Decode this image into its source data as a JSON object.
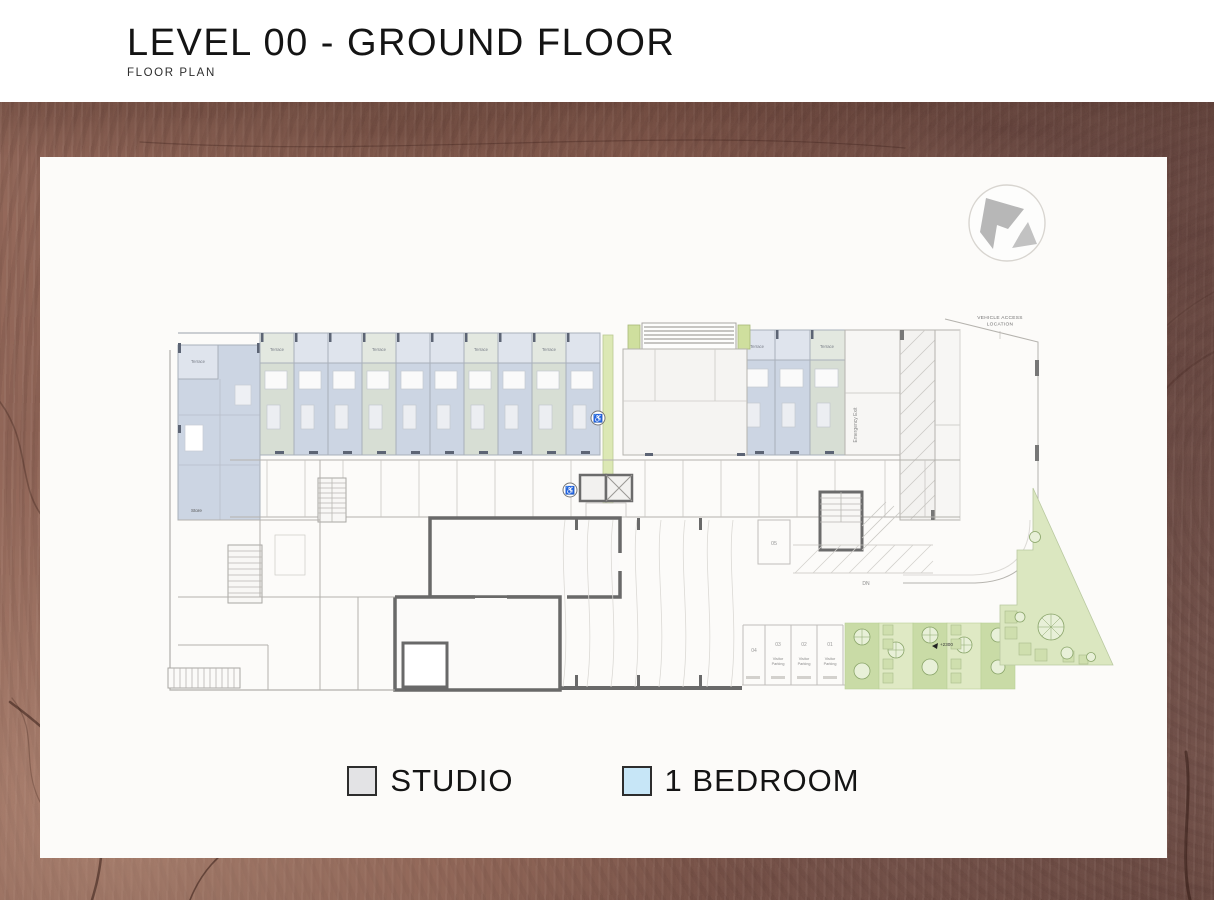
{
  "header": {
    "title": "LEVEL 00 - GROUND FLOOR",
    "subtitle": "FLOOR PLAN"
  },
  "plan": {
    "labels": {
      "vehicle_access_line1": "VEHICLE ACCESS",
      "vehicle_access_line2": "LOCATION",
      "emergency_exit": "Emergency Exit",
      "terrace": "Terrace",
      "store": "Store",
      "dn": "DN",
      "level_marker": "+2300",
      "visitor_line1": "Visitor",
      "visitor_line2": "Parking"
    },
    "parking_stalls": [
      "05",
      "04",
      "03",
      "02",
      "01"
    ]
  },
  "legend": {
    "items": [
      {
        "label": "STUDIO",
        "color": "#e3e3e5",
        "border": "#2d2d2d"
      },
      {
        "label": "1 BEDROOM",
        "color": "#c7e6f7",
        "border": "#2d2d2d"
      }
    ]
  },
  "icons": {
    "north_arrow": "north-arrow",
    "accessible": "wheelchair-accessible"
  },
  "colors": {
    "studio_unit_fill": "#d7ded4",
    "one_bedroom_unit_fill": "#ccd5e3",
    "landscape_green": "#cfdf9e",
    "garden_light": "#dbe7c0",
    "wood_brown": "#7d5549",
    "wall_dark": "#696969"
  }
}
